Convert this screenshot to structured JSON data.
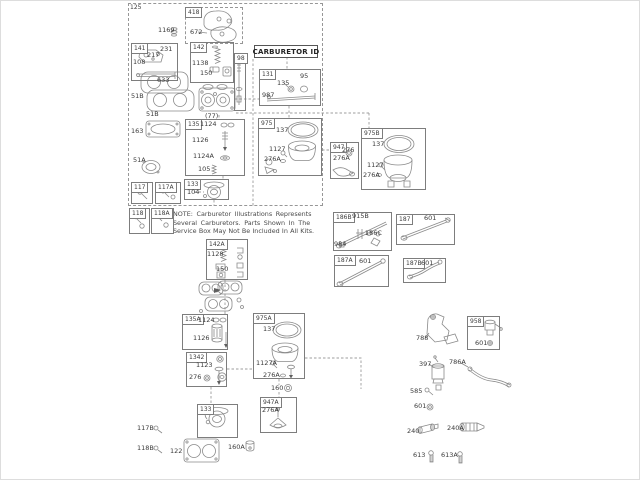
{
  "page": {
    "background": "#ffffff",
    "ink": "#3a3a3a",
    "line_art": "#8a8a8a",
    "box_border": "#7d7d7d"
  },
  "carburetor_id": {
    "title": "CARBURETOR ID"
  },
  "note": {
    "lines": [
      "NOTE:  Carburetor  Illustrations  Represents",
      "Several  Carburetors.  Parts  Shown  In  The",
      "Service Box May Not Be Included In All Kits."
    ]
  },
  "group_boxes": [
    {
      "label": "125",
      "x": 127,
      "y": 2,
      "w": 195,
      "h": 203,
      "border": "dashed",
      "plain": true
    },
    {
      "label": "418",
      "x": 184,
      "y": 6,
      "w": 58,
      "h": 37,
      "border": "dashed"
    },
    {
      "label": "141",
      "x": 130,
      "y": 42,
      "w": 47,
      "h": 38,
      "border": "solid"
    },
    {
      "label": "142",
      "x": 189,
      "y": 41,
      "w": 44,
      "h": 41,
      "border": "solid"
    },
    {
      "label": "98",
      "x": 233,
      "y": 52,
      "w": 12,
      "h": 58,
      "border": "solid"
    },
    {
      "label": "131",
      "x": 258,
      "y": 68,
      "w": 62,
      "h": 37,
      "border": "solid"
    },
    {
      "label": "135",
      "x": 184,
      "y": 118,
      "w": 60,
      "h": 57,
      "border": "solid"
    },
    {
      "label": "133",
      "x": 183,
      "y": 178,
      "w": 45,
      "h": 21,
      "border": "solid"
    },
    {
      "label": "117",
      "x": 130,
      "y": 181,
      "w": 22,
      "h": 22,
      "border": "solid"
    },
    {
      "label": "117A",
      "x": 154,
      "y": 181,
      "w": 26,
      "h": 22,
      "border": "solid"
    },
    {
      "label": "118",
      "x": 128,
      "y": 207,
      "w": 21,
      "h": 26,
      "border": "solid"
    },
    {
      "label": "118A",
      "x": 150,
      "y": 207,
      "w": 23,
      "h": 26,
      "border": "solid"
    },
    {
      "label": "975",
      "x": 257,
      "y": 117,
      "w": 64,
      "h": 58,
      "border": "solid"
    },
    {
      "label": "947",
      "x": 329,
      "y": 141,
      "w": 29,
      "h": 37,
      "border": "solid"
    },
    {
      "label": "975B",
      "x": 360,
      "y": 127,
      "w": 65,
      "h": 62,
      "border": "solid"
    },
    {
      "label": "186B",
      "x": 332,
      "y": 211,
      "w": 59,
      "h": 39,
      "border": "solid"
    },
    {
      "label": "187",
      "x": 395,
      "y": 213,
      "w": 59,
      "h": 31,
      "border": "solid"
    },
    {
      "label": "187A",
      "x": 333,
      "y": 254,
      "w": 55,
      "h": 32,
      "border": "solid"
    },
    {
      "label": "187B",
      "x": 402,
      "y": 257,
      "w": 43,
      "h": 25,
      "border": "solid"
    },
    {
      "label": "142A",
      "x": 205,
      "y": 238,
      "w": 42,
      "h": 41,
      "border": "solid"
    },
    {
      "label": "135A",
      "x": 181,
      "y": 313,
      "w": 46,
      "h": 36,
      "border": "solid"
    },
    {
      "label": "1342",
      "x": 185,
      "y": 351,
      "w": 41,
      "h": 35,
      "border": "solid"
    },
    {
      "label": "133",
      "x": 196,
      "y": 403,
      "w": 41,
      "h": 34,
      "border": "solid"
    },
    {
      "label": "975A",
      "x": 252,
      "y": 312,
      "w": 52,
      "h": 66,
      "border": "solid"
    },
    {
      "label": "947A",
      "x": 259,
      "y": 396,
      "w": 37,
      "h": 36,
      "border": "solid"
    },
    {
      "label": "958",
      "x": 466,
      "y": 315,
      "w": 33,
      "h": 34,
      "border": "solid"
    }
  ],
  "callouts": [
    {
      "text": "1169",
      "x": 157,
      "y": 26
    },
    {
      "text": "672",
      "x": 189,
      "y": 28
    },
    {
      "text": "231",
      "x": 159,
      "y": 45
    },
    {
      "text": "217",
      "x": 146,
      "y": 51
    },
    {
      "text": "108",
      "x": 132,
      "y": 58
    },
    {
      "text": "633",
      "x": 156,
      "y": 76
    },
    {
      "text": "1138",
      "x": 191,
      "y": 59
    },
    {
      "text": "150",
      "x": 199,
      "y": 69
    },
    {
      "text": "(77)",
      "x": 204,
      "y": 112
    },
    {
      "text": "51B",
      "x": 130,
      "y": 92
    },
    {
      "text": "51B",
      "x": 145,
      "y": 110
    },
    {
      "text": "163",
      "x": 130,
      "y": 127
    },
    {
      "text": "51A",
      "x": 132,
      "y": 156
    },
    {
      "text": "135",
      "x": 276,
      "y": 79
    },
    {
      "text": "95",
      "x": 299,
      "y": 72
    },
    {
      "text": "987",
      "x": 261,
      "y": 91
    },
    {
      "text": "1124",
      "x": 199,
      "y": 120
    },
    {
      "text": "1126",
      "x": 191,
      "y": 136
    },
    {
      "text": "1124A",
      "x": 192,
      "y": 152
    },
    {
      "text": "105",
      "x": 197,
      "y": 165
    },
    {
      "text": "104",
      "x": 186,
      "y": 188
    },
    {
      "text": "137",
      "x": 275,
      "y": 126
    },
    {
      "text": "1127",
      "x": 268,
      "y": 145
    },
    {
      "text": "276A",
      "x": 263,
      "y": 155
    },
    {
      "text": "276",
      "x": 341,
      "y": 146
    },
    {
      "text": "276A",
      "x": 332,
      "y": 154
    },
    {
      "text": "137",
      "x": 371,
      "y": 140
    },
    {
      "text": "1127",
      "x": 366,
      "y": 161
    },
    {
      "text": "276A",
      "x": 362,
      "y": 171
    },
    {
      "text": "915B",
      "x": 351,
      "y": 212
    },
    {
      "text": "186C",
      "x": 364,
      "y": 229
    },
    {
      "text": "984",
      "x": 333,
      "y": 240
    },
    {
      "text": "601",
      "x": 423,
      "y": 214
    },
    {
      "text": "601",
      "x": 358,
      "y": 257
    },
    {
      "text": "601",
      "x": 420,
      "y": 259
    },
    {
      "text": "1128",
      "x": 206,
      "y": 250
    },
    {
      "text": "150",
      "x": 215,
      "y": 265
    },
    {
      "text": "1124",
      "x": 197,
      "y": 316
    },
    {
      "text": "1126",
      "x": 192,
      "y": 334
    },
    {
      "text": "1123",
      "x": 195,
      "y": 361
    },
    {
      "text": "276",
      "x": 188,
      "y": 373
    },
    {
      "text": "137",
      "x": 262,
      "y": 325
    },
    {
      "text": "1127A",
      "x": 255,
      "y": 359
    },
    {
      "text": "276A",
      "x": 262,
      "y": 371
    },
    {
      "text": "160",
      "x": 270,
      "y": 384
    },
    {
      "text": "276A",
      "x": 261,
      "y": 406
    },
    {
      "text": "117B",
      "x": 136,
      "y": 424
    },
    {
      "text": "118B",
      "x": 136,
      "y": 444
    },
    {
      "text": "122",
      "x": 169,
      "y": 447
    },
    {
      "text": "160A",
      "x": 227,
      "y": 443
    },
    {
      "text": "788",
      "x": 415,
      "y": 334
    },
    {
      "text": "601",
      "x": 474,
      "y": 339
    },
    {
      "text": "397",
      "x": 418,
      "y": 360
    },
    {
      "text": "786A",
      "x": 448,
      "y": 358
    },
    {
      "text": "585",
      "x": 409,
      "y": 387
    },
    {
      "text": "601",
      "x": 413,
      "y": 402
    },
    {
      "text": "240",
      "x": 406,
      "y": 427
    },
    {
      "text": "240A",
      "x": 446,
      "y": 424
    },
    {
      "text": "613",
      "x": 412,
      "y": 451
    },
    {
      "text": "613A",
      "x": 440,
      "y": 451
    }
  ]
}
